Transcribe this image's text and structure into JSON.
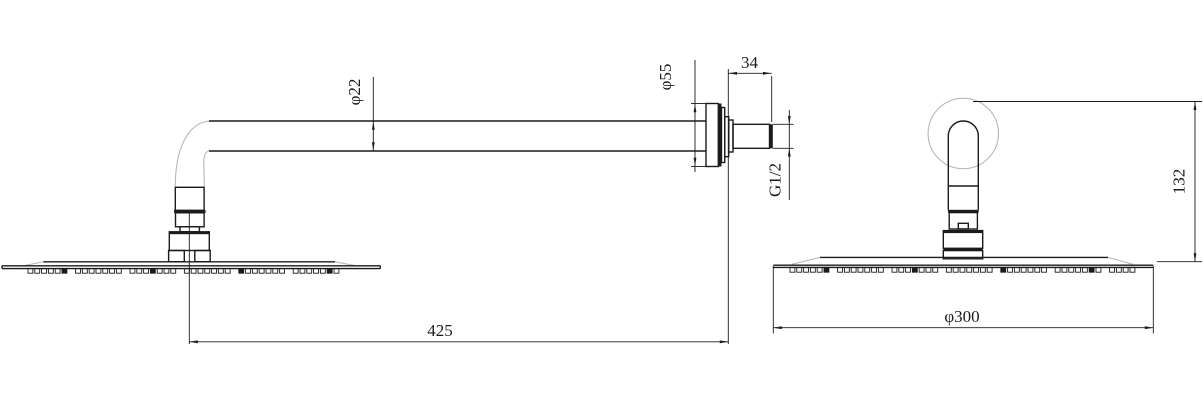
{
  "drawing": {
    "type": "technical-drawing",
    "dimensions": {
      "arm_tube_diameter": "φ22",
      "escutcheon_diameter": "φ55",
      "wall_offset": "34",
      "thread_size": "G1/2",
      "arm_length": "425",
      "head_diameter": "φ300",
      "head_drop_height": "132"
    },
    "colors": {
      "line": "#1b1b1b",
      "construction_line": "#b8b8b8",
      "background": "#ffffff"
    }
  }
}
